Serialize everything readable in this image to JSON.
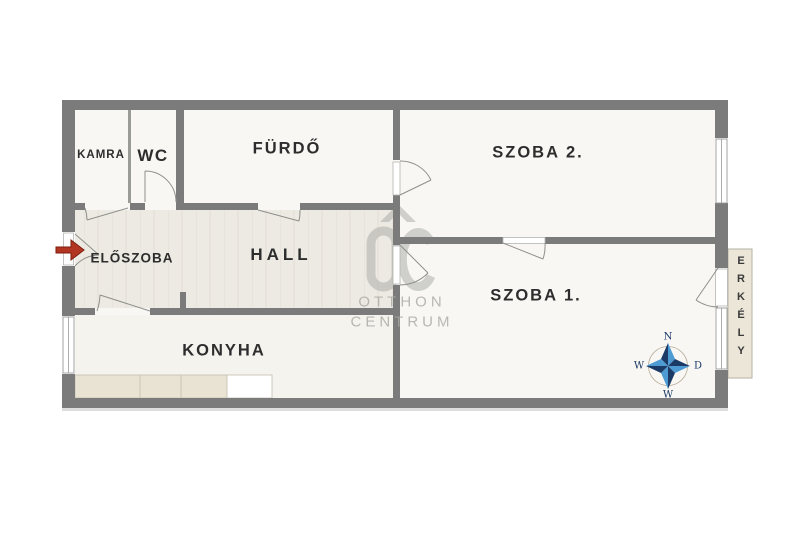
{
  "title": "apartment-floor-plan",
  "rooms": {
    "kamra": "KAMRA",
    "wc": "WC",
    "furdo": "FÜRDŐ",
    "szoba2": "SZOBA 2.",
    "eloszoba": "ELŐSZOBA",
    "hall": "HALL",
    "szoba1": "SZOBA 1.",
    "konyha": "KONYHA",
    "erkely": "ERKÉLY"
  },
  "watermark": {
    "line1": "OTTHON",
    "line2": "CENTRUM"
  },
  "compass": {
    "top": "N",
    "right": "D",
    "bottom": "W",
    "left": "W"
  },
  "colors": {
    "wall": "#7b7b7b",
    "room_floor": "#f8f7f4",
    "hall_floor": "#edeae3",
    "kitchen_floor": "#f5f3ee",
    "balcony": "#ebe6d7",
    "counter": "#e9e3d3",
    "watermark_gray": "#a8a8a3",
    "compass_dark": "#1c3a66",
    "compass_light": "#4e9bd4",
    "entrance_arrow": "#b23522"
  }
}
